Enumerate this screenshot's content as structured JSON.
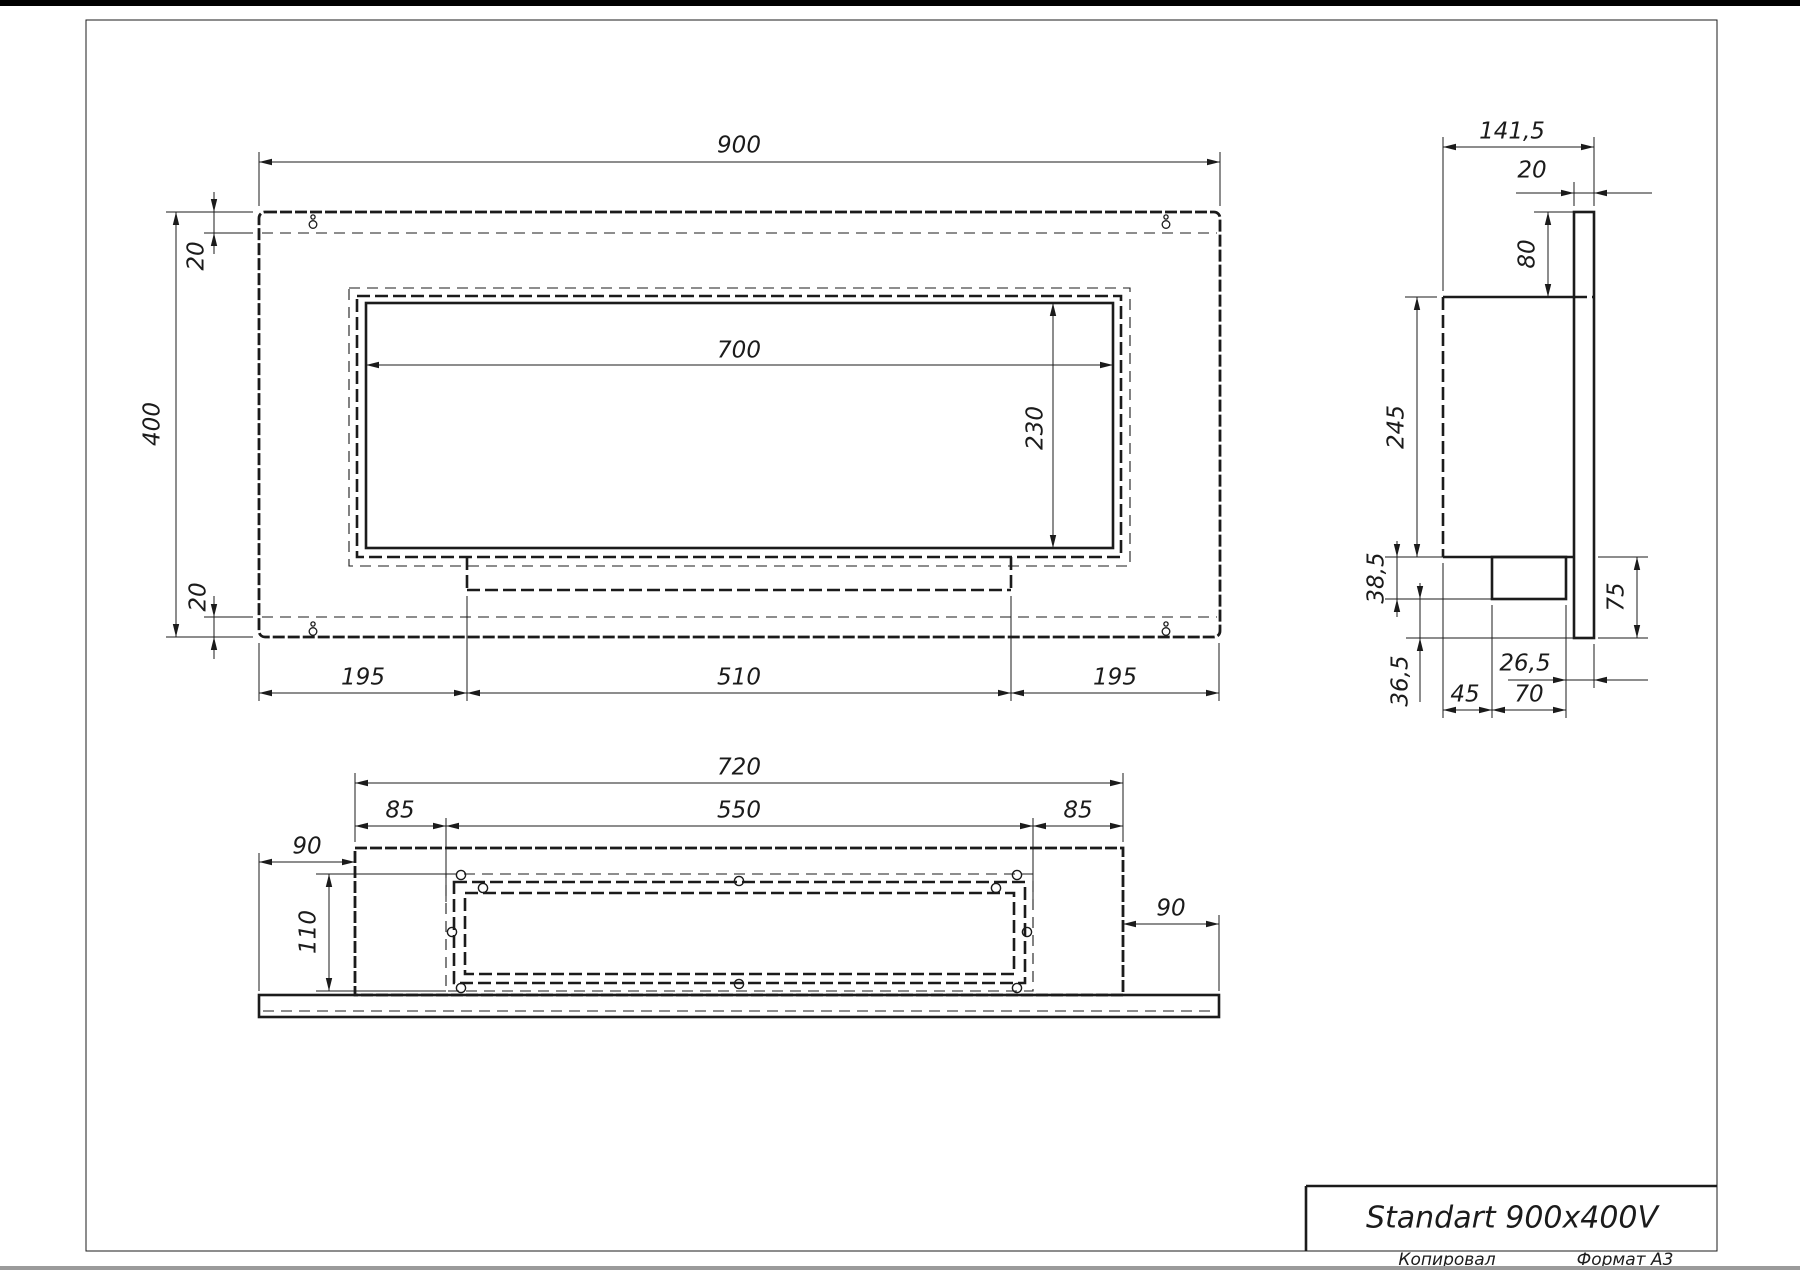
{
  "app": {
    "type": "cad-drawing-viewer"
  },
  "title_block": {
    "title": "Standart 900x400V"
  },
  "footer": {
    "copied_label": "Копировал",
    "format_label": "Формат А3"
  },
  "dimensions": {
    "front": {
      "overall_width": "900",
      "overall_height": "400",
      "top_plate_offset": "20",
      "bottom_plate_offset": "20",
      "opening_width": "700",
      "opening_height": "230",
      "left_margin": "195",
      "burner_width": "510",
      "right_margin": "195"
    },
    "side": {
      "overall_depth": "141,5",
      "plate_thickness": "20",
      "plate_top_drop": "80",
      "body_height": "245",
      "tray_depth": "38,5",
      "tray_offset": "45",
      "tray_width": "70",
      "tray_to_plate_gap": "26,5",
      "below_tray_gap": "36,5",
      "plate_bottom_drop": "75"
    },
    "bottom": {
      "body_width": "720",
      "flange_left": "85",
      "cutout_width": "550",
      "flange_right": "85",
      "plate_overhang_left": "90",
      "cutout_depth": "110",
      "plate_overhang_right": "90"
    }
  },
  "icons": {
    "mounting_hole": "keyhole-icon"
  },
  "colors": {
    "line": "#1b1b1b",
    "paper": "#ffffff",
    "top_edge": "#000000",
    "bottom_edge": "#9b9b9b"
  }
}
